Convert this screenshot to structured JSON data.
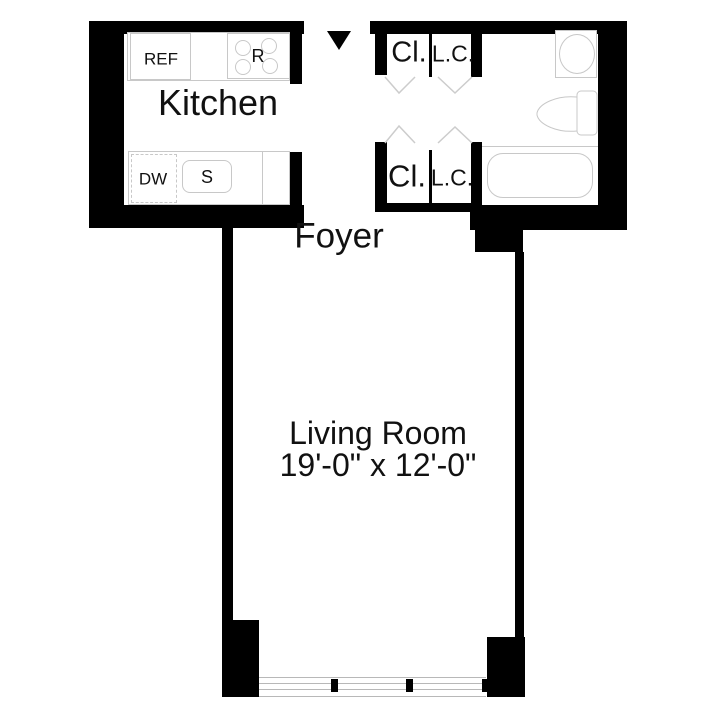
{
  "colors": {
    "wall": "#000000",
    "fixture_outline": "#c8c8c8",
    "door_swing": "#cccccc",
    "window_line": "#b8b8b8",
    "text": "#111111",
    "background": "#ffffff"
  },
  "icons": {
    "entry_arrow": "triangle-down"
  },
  "rooms": {
    "kitchen": {
      "label": "Kitchen"
    },
    "foyer": {
      "label": "Foyer"
    },
    "living_room": {
      "label": "Living Room",
      "dimensions": "19'-0\" x 12'-0\""
    }
  },
  "closets": {
    "top": {
      "left": "Cl.",
      "right": "L.C."
    },
    "bottom": {
      "left": "Cl.",
      "right": "L.C."
    }
  },
  "appliances": {
    "refrigerator": "REF",
    "range": "R",
    "dishwasher": "DW",
    "sink": "S"
  }
}
